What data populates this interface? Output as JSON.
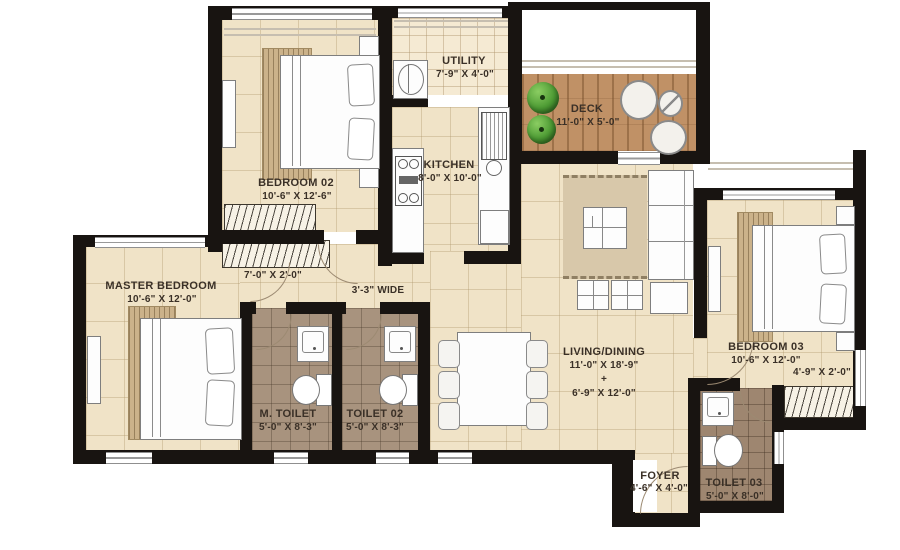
{
  "title": "Apartment Floor Plan",
  "rooms": {
    "bedroom02": {
      "name": "BEDROOM 02",
      "dims": "10'-6\" X 12'-6\""
    },
    "utility": {
      "name": "UTILITY",
      "dims": "7'-9\" X 4'-0\""
    },
    "deck": {
      "name": "DECK",
      "dims": "11'-0\" X 5'-0\""
    },
    "kitchen": {
      "name": "KITCHEN",
      "dims": "8'-0\" X 10'-0\""
    },
    "master_bedroom": {
      "name": "MASTER BEDROOM",
      "dims": "10'-6\" X 12'-0\""
    },
    "m_toilet": {
      "name": "M. TOILET",
      "dims": "5'-0\" X 8'-3\""
    },
    "toilet02": {
      "name": "TOILET 02",
      "dims": "5'-0\" X 8'-3\""
    },
    "living_dining": {
      "name": "LIVING/DINING",
      "dims": "11'-0\" X 18'-9\"",
      "joiner": "+",
      "dims2": "6'-9\" X 12'-0\""
    },
    "bedroom03": {
      "name": "BEDROOM 03",
      "dims": "10'-6\" X 12'-0\""
    },
    "foyer": {
      "name": "FOYER",
      "dims": "4'-6\" X 4'-0\""
    },
    "toilet03": {
      "name": "TOILET 03",
      "dims": "5'-0\" X 8'-0\""
    }
  },
  "annotations": {
    "master_wardrobe": "7'-0\" X 2'-0\"",
    "passage_width": "3'-3\" WIDE",
    "bedroom03_wardrobe": "4'-9\" X 2'-0\""
  },
  "colors": {
    "wall": "#181411",
    "floor_cream": "#f0e3c7",
    "floor_toilet": "#a8937e",
    "deck_wood": "#c09166",
    "plant_green": "#4c9a33",
    "label_text": "#3a3027"
  }
}
